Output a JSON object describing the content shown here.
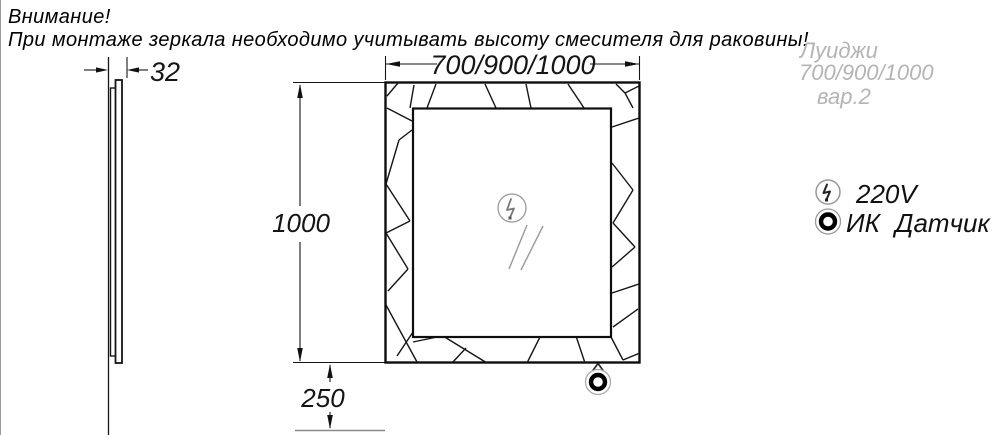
{
  "warning": {
    "line1": "Внимание!",
    "line2": "При монтаже зеркала необходимо учитывать высоту смесителя для раковины!"
  },
  "title_block": {
    "model": "Луиджи",
    "sizes": "700/900/1000",
    "variant": "вар.2"
  },
  "legend": {
    "power": {
      "icon": "lightning-icon",
      "label": "220V"
    },
    "sensor": {
      "icon": "ir-sensor-icon",
      "label": "ИК Датчик"
    }
  },
  "dimensions": {
    "width": "700/900/1000",
    "height": "1000",
    "bottom_offset": "250",
    "thickness": "32"
  },
  "colors": {
    "line": "#111111",
    "accent_gray": "#999999",
    "title_gray": "#b4b4b4",
    "floor_gray": "#8a8a8a"
  }
}
